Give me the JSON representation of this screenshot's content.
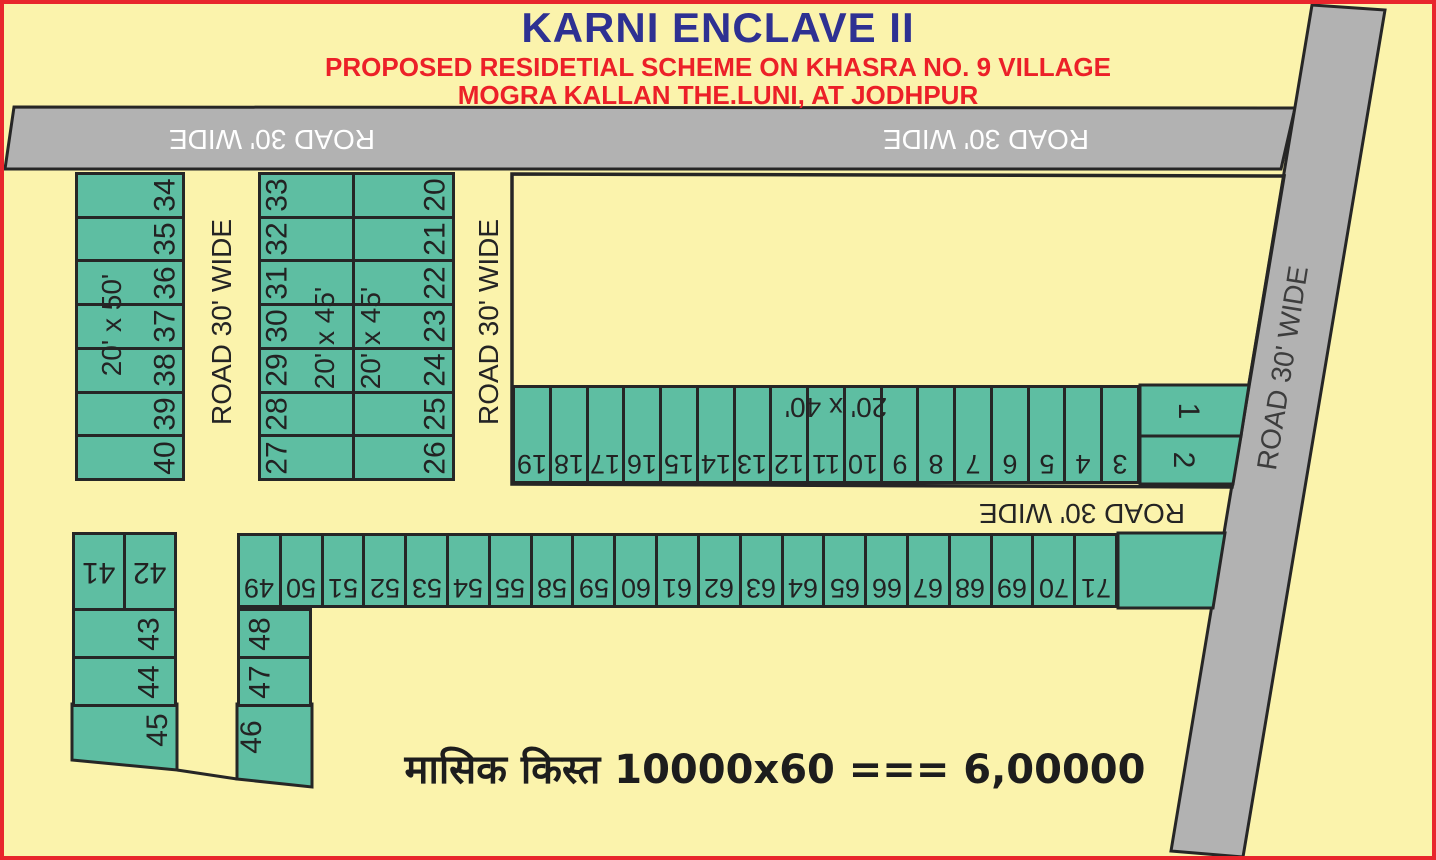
{
  "header": {
    "title": "KARNI ENCLAVE II",
    "subtitle1": "PROPOSED RESIDETIAL SCHEME ON KHASRA NO. 9 VILLAGE",
    "subtitle2": "MOGRA KALLAN THE.LUNI, AT JODHPUR"
  },
  "roads": {
    "top_left_label": "ROAD 30' WIDE",
    "top_right_label": "ROAD 30' WIDE",
    "vertical_label_1": "ROAD 30' WIDE",
    "vertical_label_2": "ROAD 30' WIDE",
    "right_label": "ROAD 30' WIDE",
    "middle_label": "ROAD 30' WIDE"
  },
  "dimensions": {
    "block_a": "20'  x  50'",
    "block_b_left": "20'  x  45'",
    "block_b_right": "20'  x  45'",
    "strip": "20'  x  40'"
  },
  "blocks": {
    "a": {
      "plots": [
        "34",
        "35",
        "36",
        "37",
        "38",
        "39",
        "40"
      ]
    },
    "b_left": {
      "plots": [
        "33",
        "32",
        "31",
        "30",
        "29",
        "28",
        "27"
      ]
    },
    "b_right": {
      "plots": [
        "20",
        "21",
        "22",
        "23",
        "24",
        "25",
        "26"
      ]
    },
    "strip": {
      "plots": [
        "19",
        "18",
        "17",
        "16",
        "15",
        "14",
        "13",
        "12",
        "11",
        "10",
        "9",
        "8",
        "7",
        "6",
        "5",
        "4",
        "3"
      ]
    },
    "corner": {
      "p1": "1",
      "p2": "2"
    },
    "long_row": {
      "plots": [
        "49",
        "50",
        "51",
        "52",
        "53",
        "54",
        "55",
        "58",
        "59",
        "60",
        "61",
        "62",
        "63",
        "64",
        "65",
        "66",
        "67",
        "68",
        "69",
        "70",
        "71"
      ]
    },
    "left_bottom": {
      "top_row": [
        "41",
        "42"
      ],
      "p43": "43",
      "p44": "44",
      "p45": "45"
    },
    "mid_bottom": {
      "p46": "46",
      "p47": "47",
      "p48": "48"
    }
  },
  "footer": {
    "installment_text": "मासिक किस्त 10000x60 === 6,00000"
  },
  "colors": {
    "background": "#FBF3AC",
    "plot_green": "#5EBEA2",
    "road_gray": "#B2B2B2",
    "outline_dark": "#262626",
    "title_blue": "#2E3192",
    "accent_red": "#EC2028"
  }
}
